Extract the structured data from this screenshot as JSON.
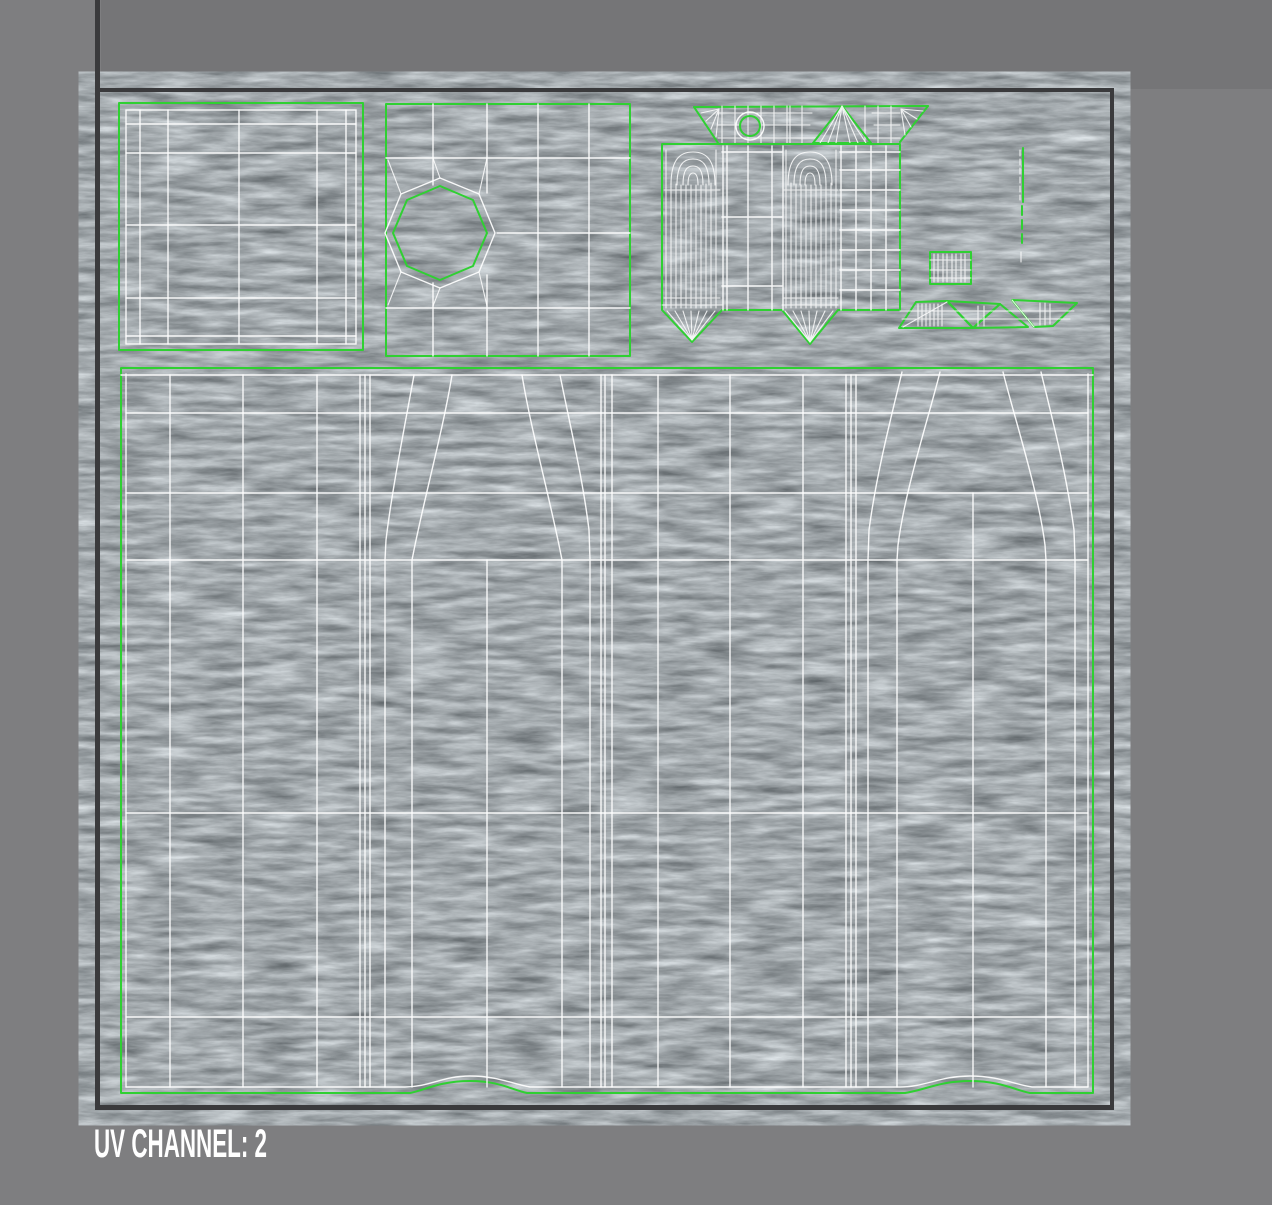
{
  "app": {
    "description": "UV texture editor viewport showing unwrapped UV islands over a rough gray texture",
    "uv_channel_value": "2"
  },
  "caption": {
    "text": "UV CHANNEL: 2"
  },
  "colors": {
    "background": "#7e7e80",
    "top_strip": "#757577",
    "frame": "#3a3a3c",
    "texture_base": "#a2a8ac",
    "wireframe": "#ffffff",
    "seam": "#2fd032",
    "text": "#ffffff"
  },
  "canvas": {
    "islands": [
      {
        "name": "beveled-square-face"
      },
      {
        "name": "square-face-with-octagon-hole"
      },
      {
        "name": "cylinder-and-panel-shell"
      },
      {
        "name": "small-ribbed-rectangle"
      },
      {
        "name": "thin-seam-strip"
      },
      {
        "name": "triangle-fan-strip"
      },
      {
        "name": "large-garment-panel"
      }
    ]
  }
}
